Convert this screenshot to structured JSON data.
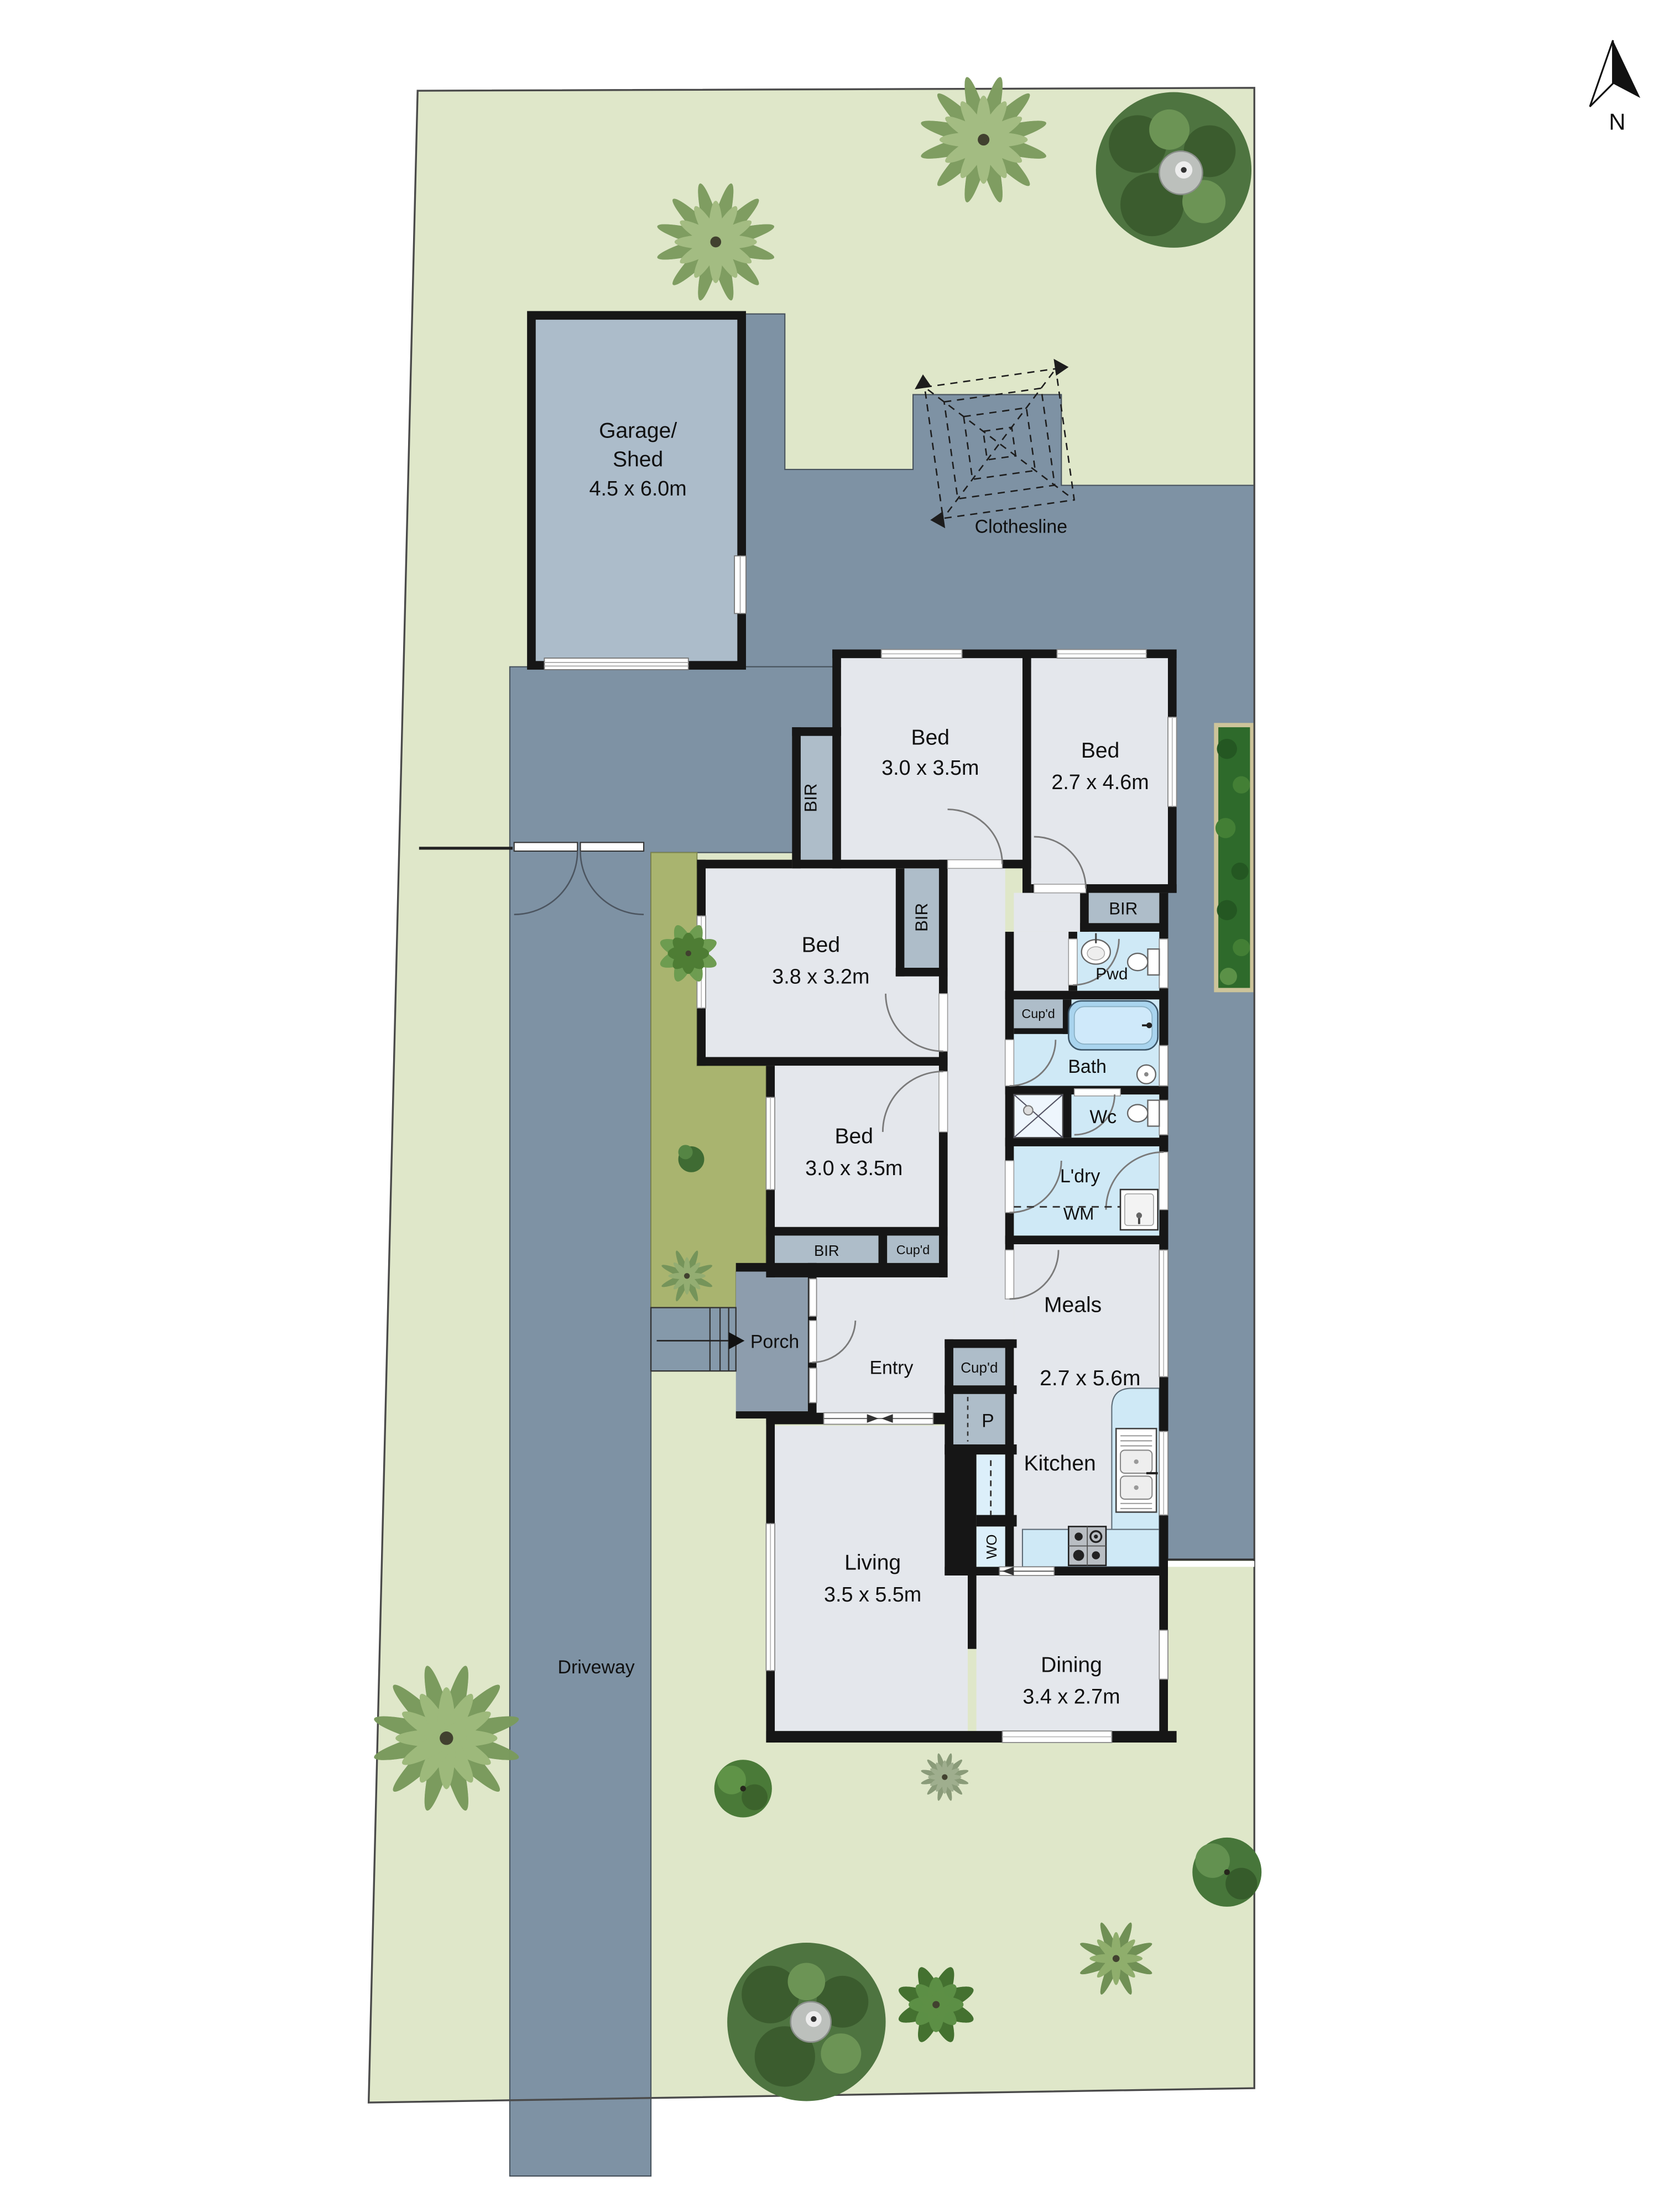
{
  "plan_title": "Residential site floor plan",
  "north": {
    "label": "N"
  },
  "site": {
    "driveway_label": "Driveway",
    "clothesline_label": "Clothesline",
    "porch_label": "Porch",
    "colors": {
      "lawn": "#dfe7c9",
      "paving": "#7e92a4",
      "garden_bed": "#a9b46f",
      "hedge": "#2e6a2b",
      "room_floor": "#e4e7ec",
      "closet": "#aebdc9",
      "wet_area": "#cfe9f6",
      "porch": "#8d9dad",
      "garage_floor": "#acbcca",
      "wall": "#161616"
    }
  },
  "rooms": {
    "garage": {
      "l1": "Garage/",
      "l2": "Shed",
      "dims": "4.5 x 6.0m"
    },
    "bed1": {
      "label": "Bed",
      "dims": "3.0 x 3.5m"
    },
    "bed2": {
      "label": "Bed",
      "dims": "2.7 x 4.6m"
    },
    "bed3": {
      "label": "Bed",
      "dims": "3.8 x 3.2m"
    },
    "bed4": {
      "label": "Bed",
      "dims": "3.0 x 3.5m"
    },
    "living": {
      "label": "Living",
      "dims": "3.5 x 5.5m"
    },
    "dining": {
      "label": "Dining",
      "dims": "3.4 x 2.7m"
    },
    "meals": {
      "label": "Meals",
      "dims": "2.7 x 5.6m"
    },
    "kitchen": {
      "label": "Kitchen"
    },
    "entry": {
      "label": "Entry"
    },
    "bath": {
      "label": "Bath"
    },
    "pwd": {
      "label": "Pwd"
    },
    "wc": {
      "label": "Wc"
    },
    "ldry": {
      "label": "L'dry",
      "wm": "WM"
    },
    "pantry": {
      "label": "P"
    },
    "wall_oven": {
      "label": "WO"
    },
    "bir": "BIR",
    "cupd": "Cup'd"
  }
}
